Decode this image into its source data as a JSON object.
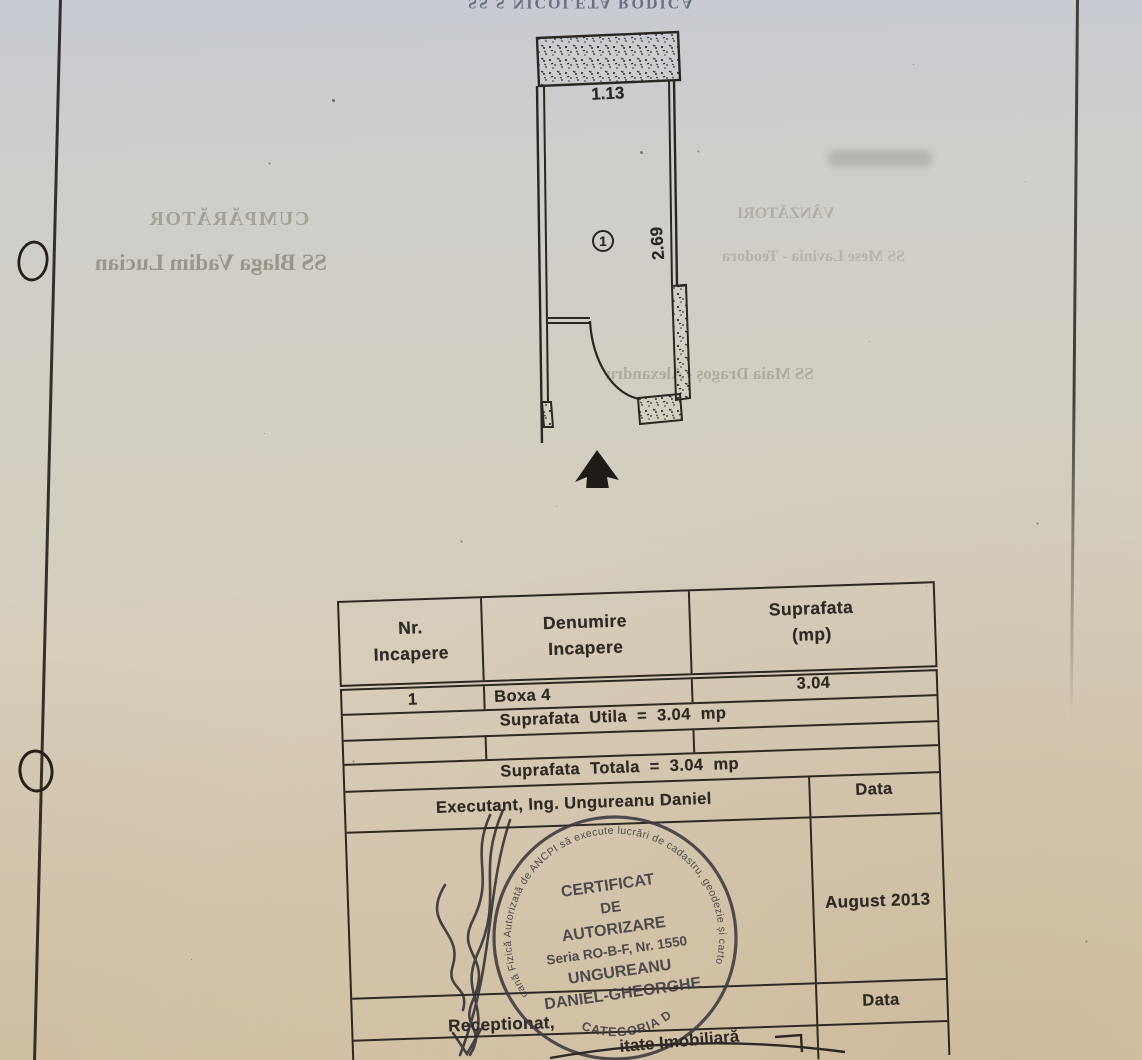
{
  "plan": {
    "room_number": "1",
    "width_label": "1.13",
    "height_label": "2.69"
  },
  "table": {
    "col_headers": [
      "Nr.\nIncapere",
      "Denumire\nIncapere",
      "Suprafata\n(mp)"
    ],
    "row": {
      "nr": "1",
      "name": "Boxa 4",
      "area": "3.04"
    },
    "utila_line": "Suprafata Utila = 3.04 mp",
    "totala_line": "Suprafata Totala = 3.04 mp",
    "executant_line": "Executant, Ing. Ungureanu Daniel",
    "data_label": "Data",
    "date_value": "August 2013",
    "receptionat_label": "Receptionat,",
    "data_label_2": "Data"
  },
  "stamp": {
    "rim_text": "Persoană Fizică Autorizată de ANCPI să execute lucrări de cadastru, geodezie și cartografie",
    "rim_bottom": "CATEGORIA D",
    "line1": "CERTIFICAT",
    "line2": "DE",
    "line3": "AUTORIZARE",
    "line4": "Seria RO-B-F, Nr. 1550",
    "line5": "UNGUREANU",
    "line6": "DANIEL-GHEORGHE"
  },
  "bottom_fragment": "itate Imobiliară",
  "bleedthrough": {
    "top_line": "SS S NICOLETA RODICA",
    "buyer_heading": "CUMPĂRĂTOR",
    "buyer_name": "SS Blaga Vadim Lucian",
    "seller_heading": "VÂNZĂTORI",
    "seller_name": "SS Mese Lavinia - Teodora",
    "witness_name": "SS Maia Dragoș - Alexandru"
  }
}
